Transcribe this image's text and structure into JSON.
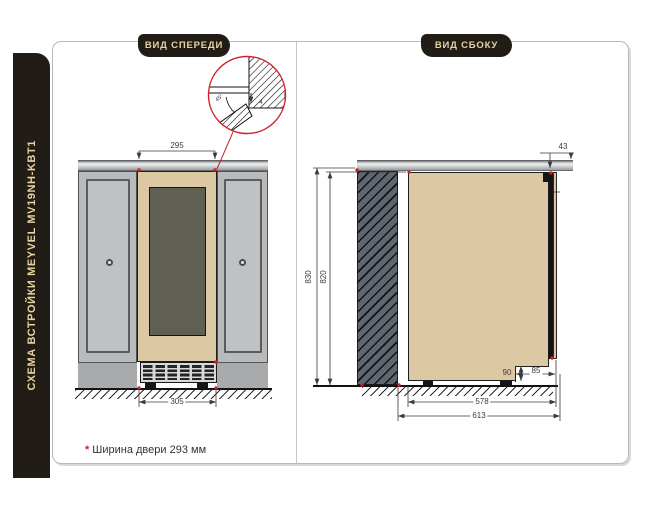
{
  "sidebar": {
    "title": "СХЕМА ВСТРОЙКИ MEYVEL MV19NH-KBT1"
  },
  "front": {
    "badge": "ВИД СПЕРЕДИ",
    "dims": {
      "top_width": "295",
      "bottom_width": "305"
    },
    "detail": {
      "angle": "45°",
      "gap": "4"
    }
  },
  "side": {
    "badge": "ВИД СБОКУ",
    "dims": {
      "niche_height": "830",
      "unit_height": "820",
      "depth_no_door": "578",
      "depth_total": "613",
      "top_offset": "43",
      "plinth_height": "90",
      "plinth_depth": "85"
    }
  },
  "footnote": {
    "marker": "*",
    "text": "Ширина двери 293 мм"
  },
  "colors": {
    "accent_red": "#cf2127",
    "panel_dark": "#211c16",
    "label_cream": "#e9d2a4",
    "body_tan": "#dcc8a2",
    "glass_dark": "#5f5f53",
    "cabinet_gray": "#b9babc",
    "wall_section_gray": "#5e6770"
  }
}
